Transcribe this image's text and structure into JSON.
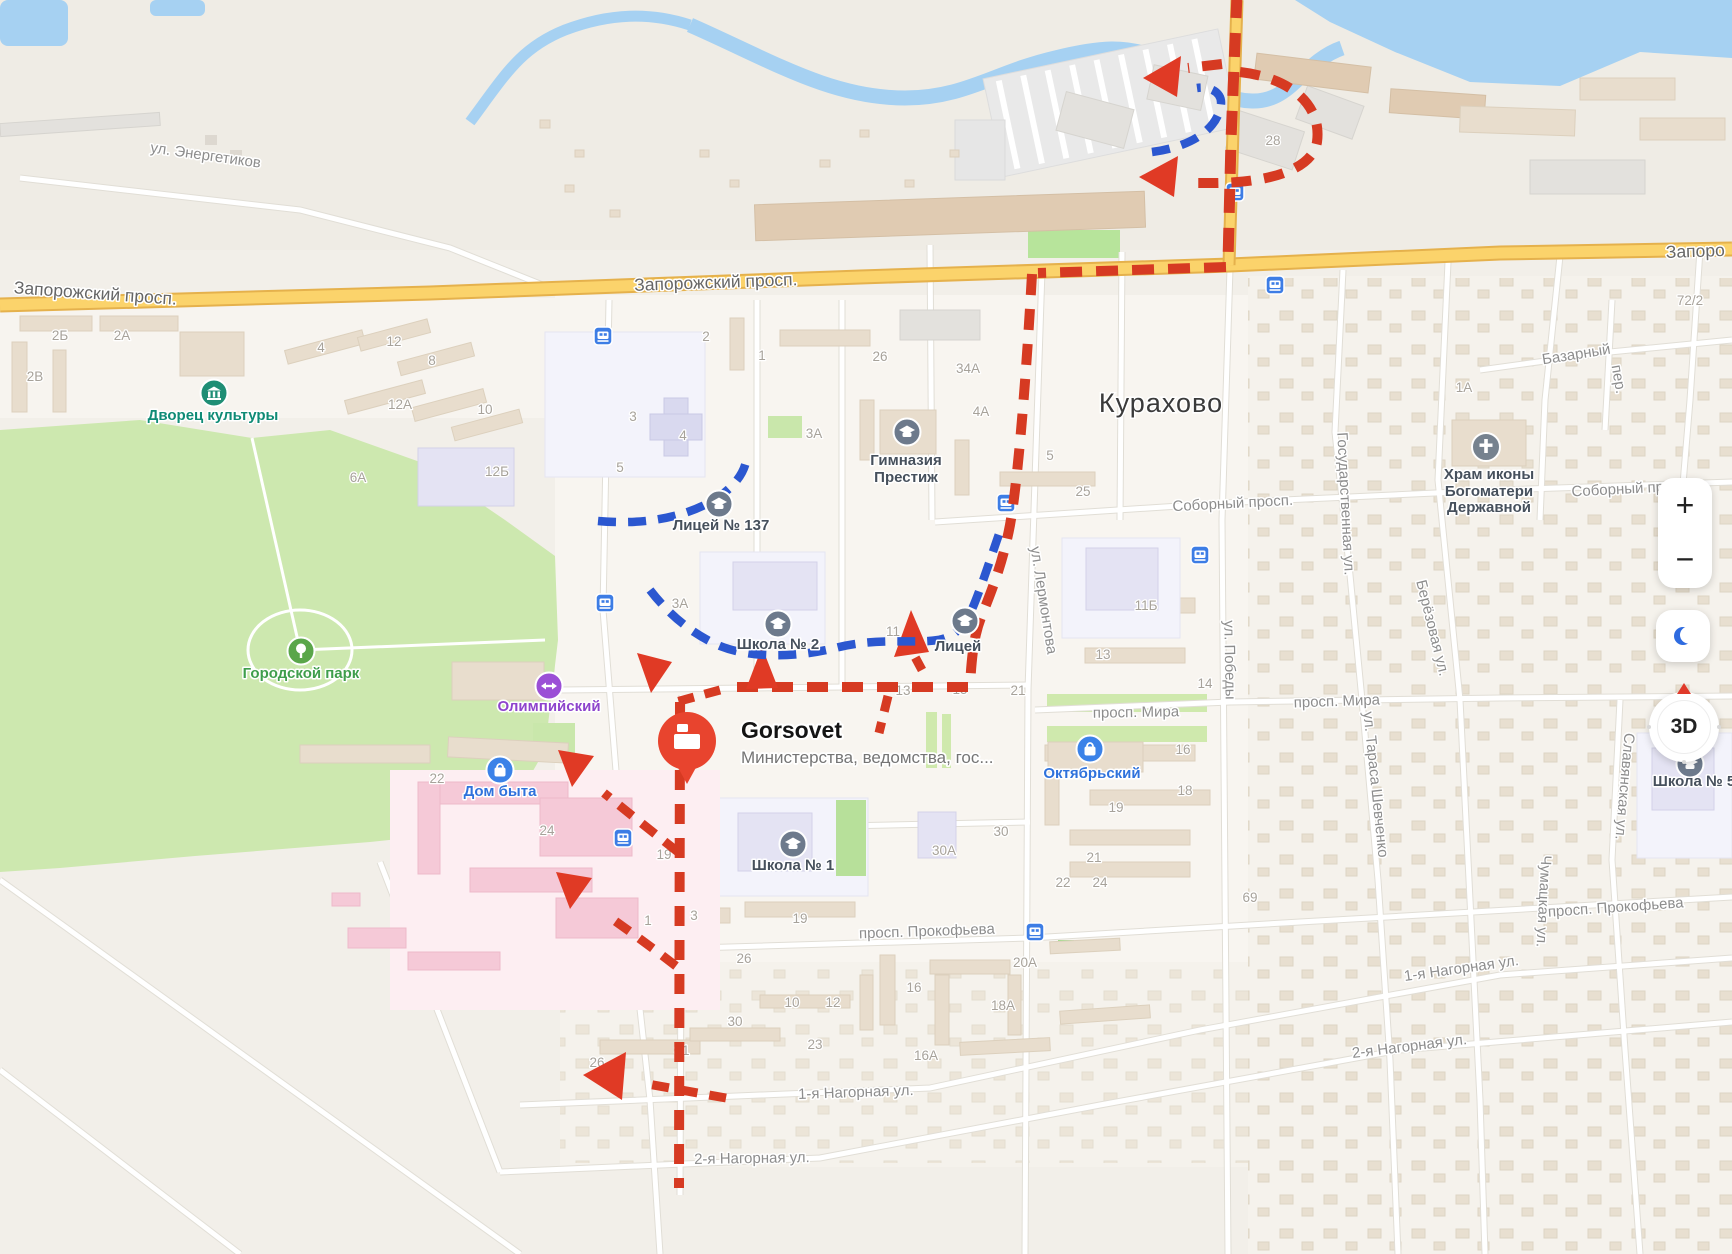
{
  "city": "Курахово",
  "place_card": {
    "title": "Gorsovet",
    "subtitle": "Министерства, ведомства, гос..."
  },
  "streets": [
    "ул. Энергетиков",
    "Запорожский просп.",
    "Запоро",
    "Соборный просп.",
    "Соборный пр",
    "Государственная ул.",
    "Берёзовая ул.",
    "ул. Лермонтова",
    "ул. Победы",
    "просп. Мира",
    "ул. Тараса Шевченко",
    "Славянская ул.",
    "просп. Прокофьева",
    "1-я Нагорная ул.",
    "2-я Нагорная ул.",
    "Чумацкая ул.",
    "Базарный",
    "пер."
  ],
  "poi": {
    "palace": "Дворец культуры",
    "park": "Городской парк",
    "olympic": "Олимпийский",
    "dom_byta": "Дом быта",
    "oktyabrsky": "Октябрьский",
    "school2": "Школа № 2",
    "school1": "Школа № 1",
    "school5": "Школа № 5",
    "lyceum137": "Лицей № 137",
    "lyceum": "Лицей",
    "gymnasium_line1": "Гимназия",
    "gymnasium_line2": "Престиж",
    "church_line1": "Храм иконы",
    "church_line2": "Богоматери",
    "church_line3": "Державной"
  },
  "house_numbers": [
    "2Б",
    "2А",
    "2В",
    "4",
    "12",
    "8",
    "12А",
    "10",
    "12Б",
    "6А",
    "3",
    "4",
    "5",
    "2",
    "1",
    "26",
    "34А",
    "4А",
    "3А",
    "5",
    "25",
    "11Б",
    "13",
    "14",
    "16",
    "18",
    "19",
    "21",
    "69",
    "13",
    "15",
    "21",
    "11",
    "3А",
    "30",
    "30А",
    "19",
    "19",
    "1",
    "3",
    "26",
    "10",
    "12",
    "30",
    "23",
    "31",
    "16",
    "16А",
    "20А",
    "18А",
    "22",
    "24",
    "22",
    "24",
    "72/2",
    "1А",
    "28",
    "26"
  ],
  "controls": {
    "zoom_in": "+",
    "zoom_out": "−",
    "compass": "3D"
  },
  "colors": {
    "route_red": "#d63a22",
    "route_blue": "#2b57d0",
    "road_yellow": "#fbd36b",
    "water": "#a6d1f2",
    "park_green": "#cde8af",
    "pin_red": "#e8442e"
  }
}
